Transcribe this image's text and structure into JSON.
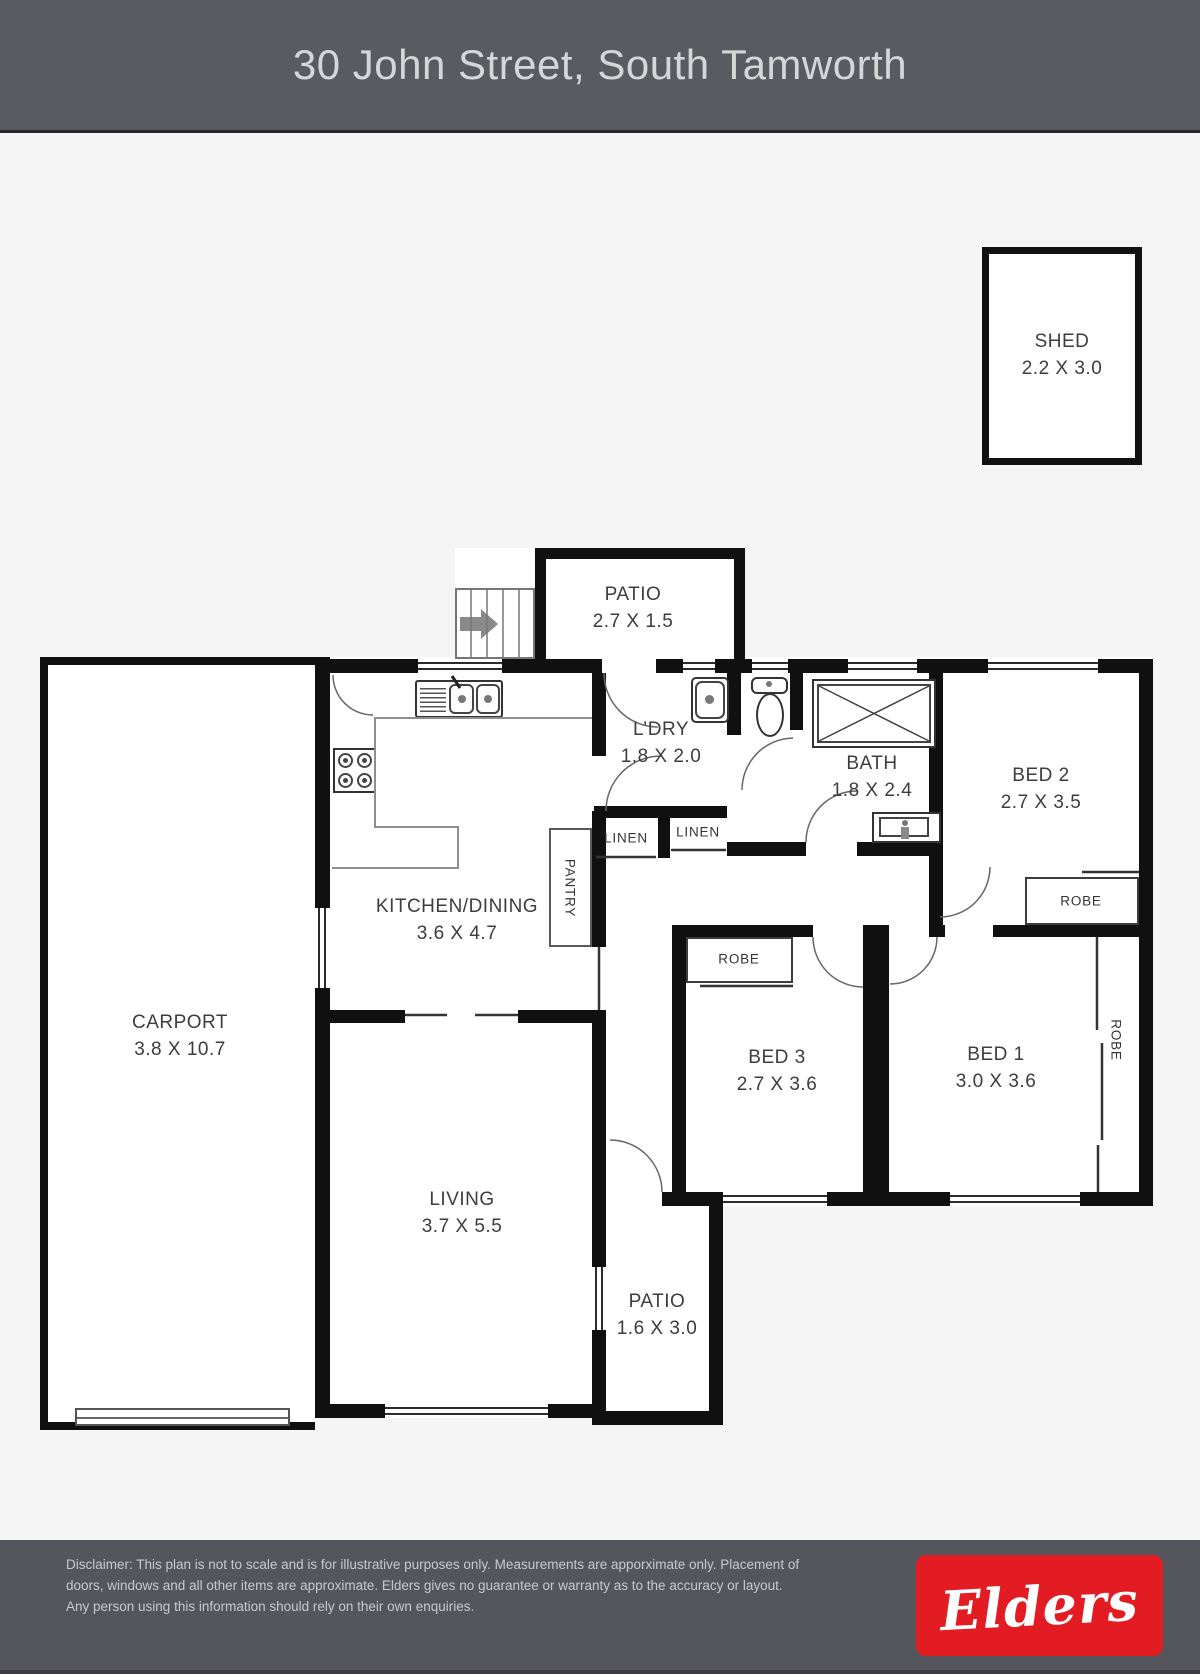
{
  "header": {
    "title": "30 John Street, South Tamworth"
  },
  "rooms": {
    "shed": {
      "label": "SHED",
      "dims": "2.2 X 3.0"
    },
    "patio_top": {
      "label": "PATIO",
      "dims": "2.7 X 1.5"
    },
    "ldry": {
      "label": "L’DRY",
      "dims": "1.8 X 2.0"
    },
    "bath": {
      "label": "BATH",
      "dims": "1.8 X 2.4"
    },
    "bed2": {
      "label": "BED 2",
      "dims": "2.7 X 3.5"
    },
    "kitchen": {
      "label": "KITCHEN/DINING",
      "dims": "3.6 X 4.7"
    },
    "carport": {
      "label": "CARPORT",
      "dims": "3.8 X 10.7"
    },
    "bed3": {
      "label": "BED 3",
      "dims": "2.7 X 3.6"
    },
    "bed1": {
      "label": "BED 1",
      "dims": "3.0 X 3.6"
    },
    "living": {
      "label": "LIVING",
      "dims": "3.7 X 5.5"
    },
    "patio_bottom": {
      "label": "PATIO",
      "dims": "1.6 X 3.0"
    }
  },
  "closets": {
    "linen1": "LINEN",
    "linen2": "LINEN",
    "pantry": "PANTRY",
    "robe_bed2": "ROBE",
    "robe_bed3": "ROBE",
    "robe_bed1": "ROBE"
  },
  "footer": {
    "disclaimer_lines": [
      "Disclaimer: This plan is not to scale and is for illustrative purposes only. Measurements are apporximate only. Placement of",
      "doors, windows and all other items are approximate. Elders gives no guarantee or warranty as to the accuracy or layout.",
      "Any person using this information should rely on their own enquiries."
    ],
    "brand": "Elders"
  },
  "colors": {
    "brand_red": "#e31b22",
    "band_gray": "#5a5b60",
    "wall_black": "#101010"
  }
}
